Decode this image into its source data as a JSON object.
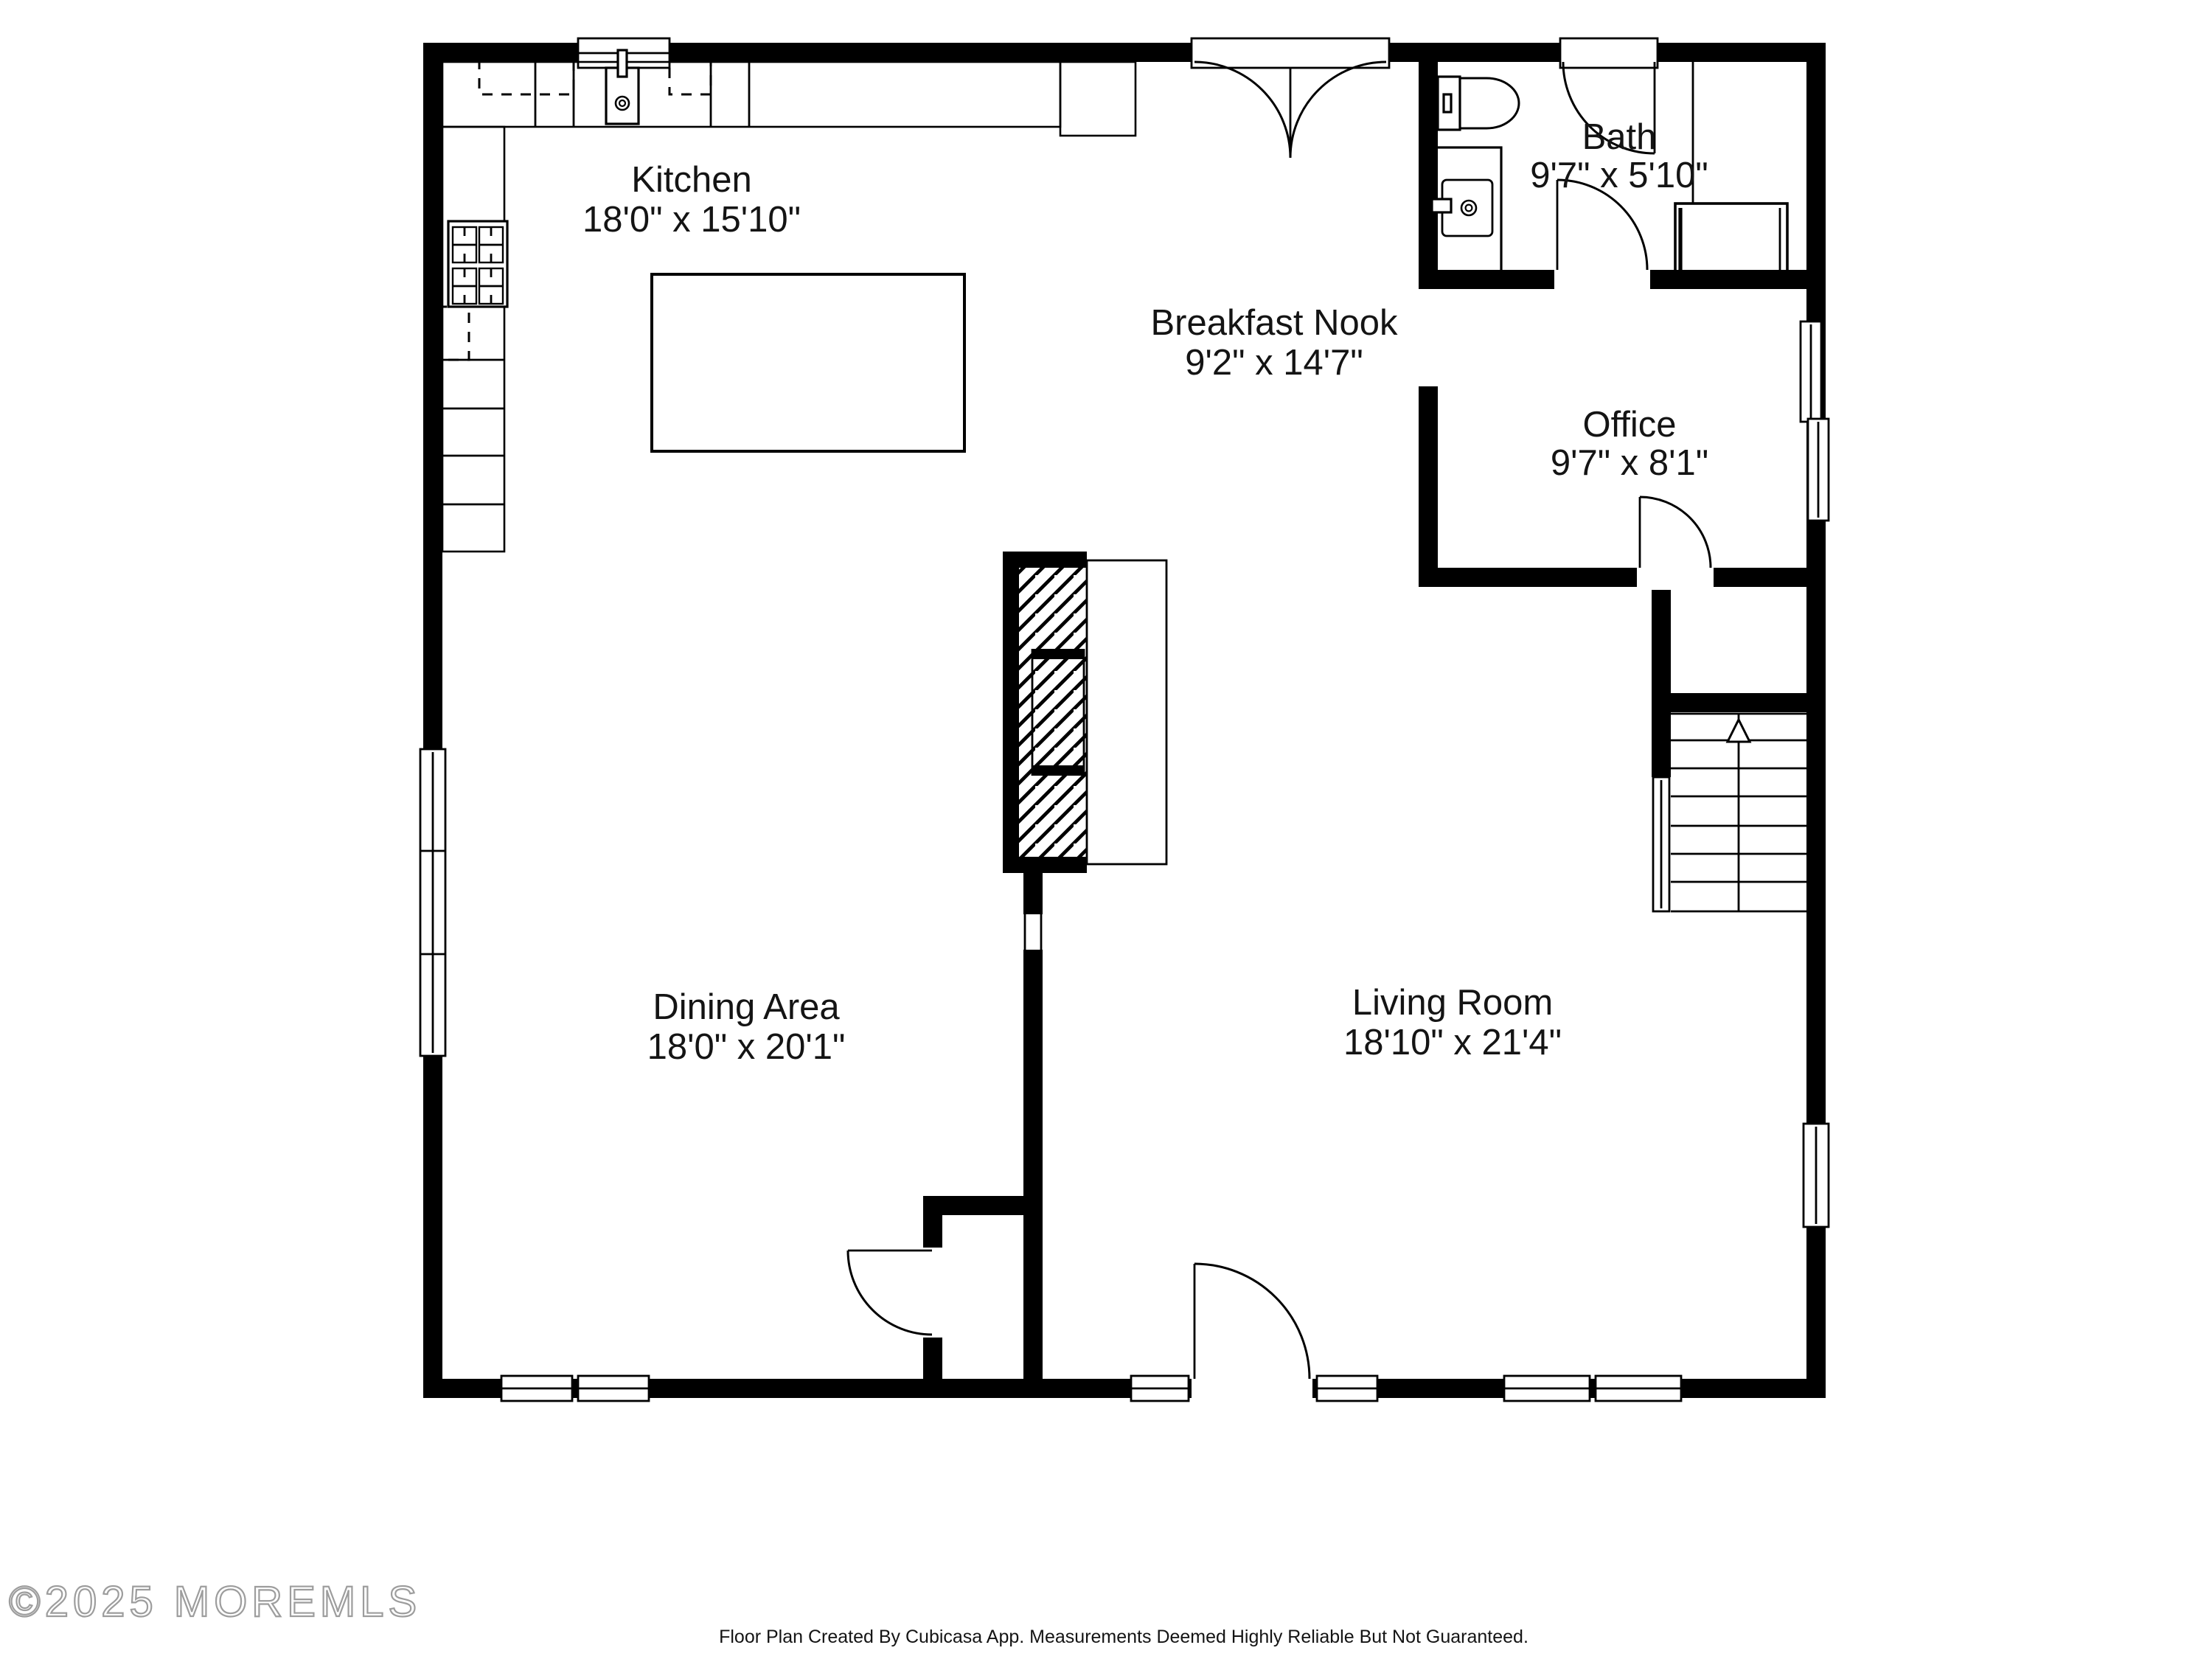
{
  "floor_plan": {
    "rooms": [
      {
        "id": "kitchen",
        "name": "Kitchen",
        "dimensions": "18'0\" x 15'10\""
      },
      {
        "id": "breakfast-nook",
        "name": "Breakfast Nook",
        "dimensions": "9'2\" x 14'7\""
      },
      {
        "id": "bath",
        "name": "Bath",
        "dimensions": "9'7\" x 5'10\""
      },
      {
        "id": "office",
        "name": "Office",
        "dimensions": "9'7\" x 8'1\""
      },
      {
        "id": "dining-area",
        "name": "Dining Area",
        "dimensions": "18'0\" x 20'1\""
      },
      {
        "id": "living-room",
        "name": "Living Room",
        "dimensions": "18'10\" x 21'4\""
      }
    ],
    "watermark": "©2025 MOREMLS",
    "footer": "Floor Plan Created By Cubicasa App. Measurements Deemed Highly Reliable But Not Guaranteed.",
    "colors": {
      "walls": "#000000",
      "background": "#ffffff",
      "label_text": "#141414",
      "watermark": "#9d9d9d"
    },
    "symbols": [
      "door-arc",
      "window",
      "french-doors",
      "stairs-up-arrow",
      "toilet",
      "vanity-sink",
      "shower",
      "stove",
      "kitchen-sink",
      "kitchen-island",
      "fireplace",
      "counters",
      "upper-cabinets-dashed"
    ]
  }
}
